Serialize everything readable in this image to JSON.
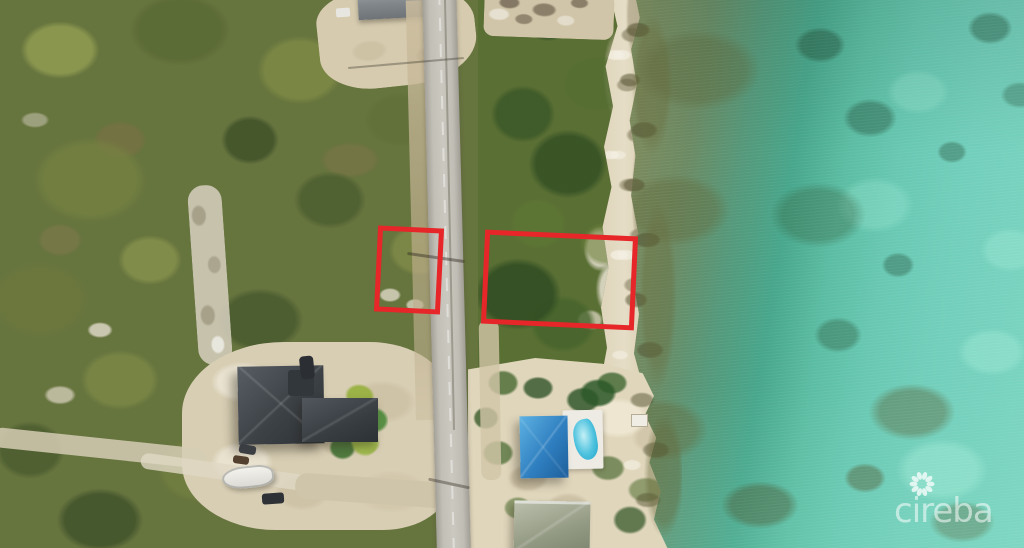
{
  "scene": {
    "type": "aerial-drone-photo",
    "subject": "Two vacant land lots outlined in red along a coastal road, beside beach and turquoise reef water"
  },
  "watermark": {
    "text": "cireba",
    "icon": "pinwheel-petal-logo-icon"
  },
  "annotations": {
    "outline_color": "#e62629",
    "lots": [
      {
        "id": "lot-west",
        "position": "inland side of road"
      },
      {
        "id": "lot-east",
        "position": "beach side of road"
      }
    ]
  },
  "palette": {
    "lot_outline": "#e62629",
    "scrub_green": "#66743e",
    "scrub_dark": "#42512a",
    "scrub_light": "#8f9c52",
    "sand": "#d9cfb4",
    "rock_white": "#e6e0d2",
    "road_gray": "#c2bfb7",
    "sea_nearshore_olive": "#8d935f",
    "sea_teal": "#47a68b",
    "sea_turquoise": "#72cfbb",
    "sea_bright": "#8adcc9",
    "roof_dark_gray": "#3c4146",
    "roof_blue": "#2f7fc0",
    "pool_blue": "#3cb8d8",
    "deck_white": "#edebe4",
    "roof_sage": "#939a83",
    "boat_white": "#f5f4ef",
    "watermark_white": "#ffffff"
  }
}
